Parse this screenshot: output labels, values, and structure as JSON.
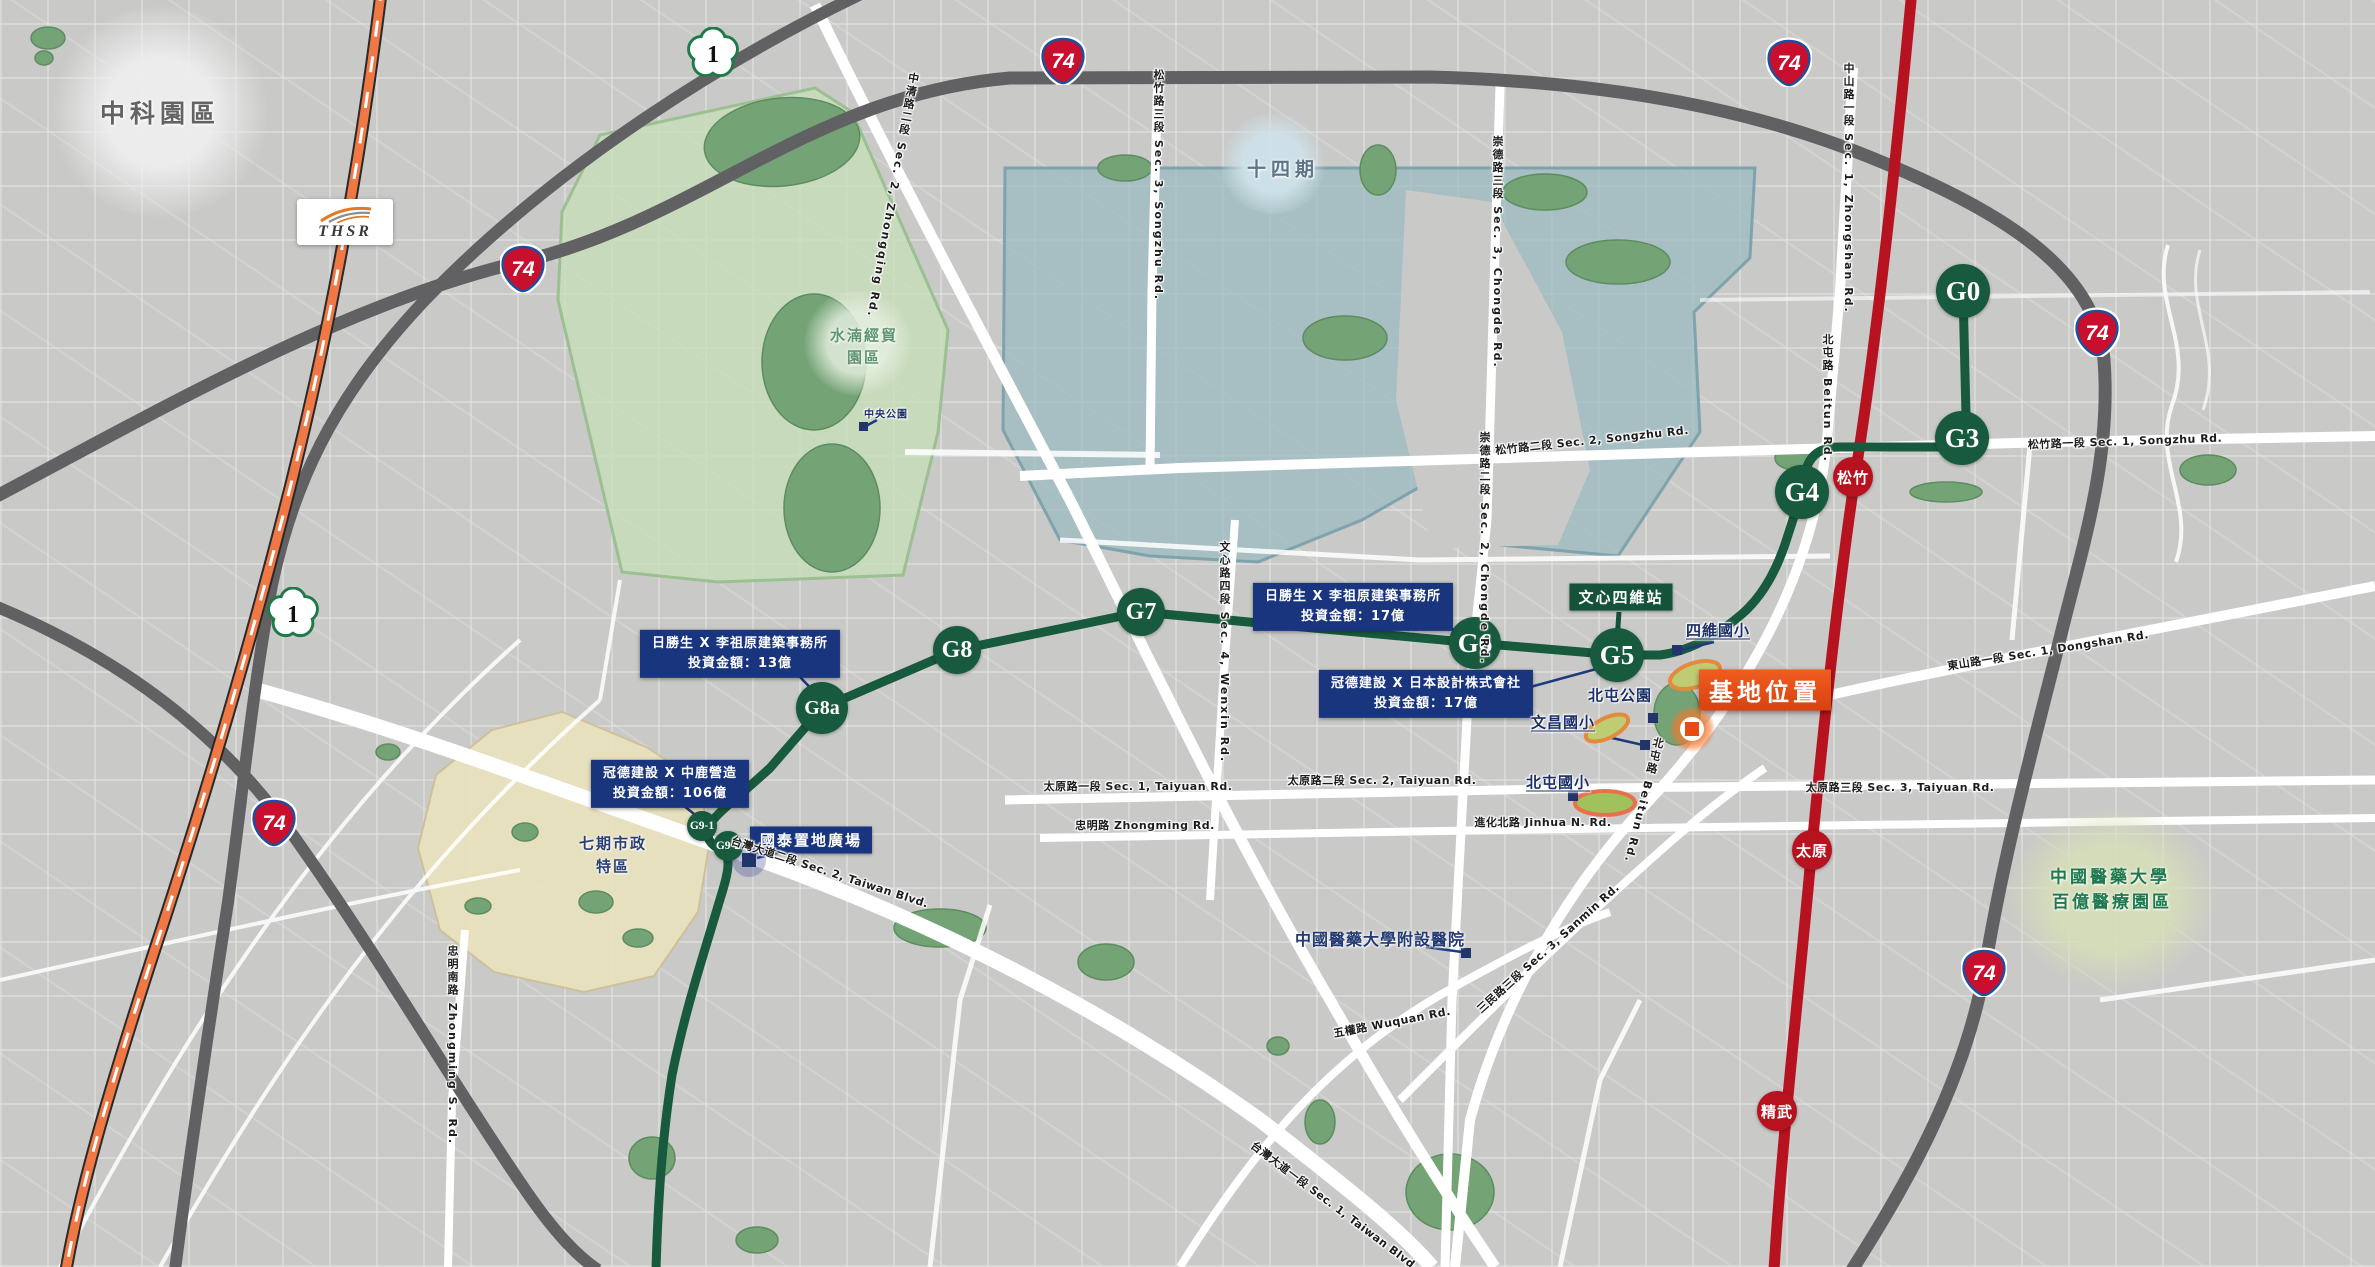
{
  "colors": {
    "map_background": "#c9c9c8",
    "green_line": "#185a3d",
    "red_line": "#b6121f",
    "highway_gray": "#616163",
    "thsr_orange": "#ef7844",
    "info_box_navy": "#19357e",
    "site_box_orange": "#e8521c",
    "area_shuinan_green": "#c8deba",
    "area_phase14_teal": "#9ebdc2",
    "area_phase7_beige": "#e9e2be"
  },
  "thsr": {
    "label": "THSR"
  },
  "shield_labels": {
    "expressway": "74",
    "national": "1"
  },
  "areas": {
    "zhongke": {
      "label": "中科園區"
    },
    "shuinan": {
      "line1": "水湳經貿",
      "line2": "園區"
    },
    "phase14": {
      "label": "十四期"
    },
    "phase7": {
      "line1": "七期市政",
      "line2": "特區"
    },
    "cmu_hospital": {
      "label": "中國醫藥大學附設醫院"
    },
    "cmu_medical_park": {
      "line1": "中國醫藥大學",
      "line2": "百億醫療園區"
    }
  },
  "site": {
    "label": "基地位置"
  },
  "transit": {
    "wenxin_siwei_box": {
      "label": "文心四維站"
    },
    "green_line_stations": [
      {
        "id": "G0",
        "name": "g0",
        "x": 1963,
        "y": 291,
        "r": 27
      },
      {
        "id": "G3",
        "name": "g3",
        "x": 1962,
        "y": 438,
        "r": 27
      },
      {
        "id": "G4",
        "name": "g4",
        "x": 1802,
        "y": 492,
        "r": 27
      },
      {
        "id": "G5",
        "name": "g5",
        "x": 1617,
        "y": 655,
        "r": 27
      },
      {
        "id": "G6",
        "name": "g6",
        "x": 1475,
        "y": 643,
        "r": 26
      },
      {
        "id": "G7",
        "name": "g7",
        "x": 1141,
        "y": 612,
        "r": 24
      },
      {
        "id": "G8",
        "name": "g8",
        "x": 957,
        "y": 650,
        "r": 24
      },
      {
        "id": "G8a",
        "name": "g8a",
        "x": 822,
        "y": 708,
        "r": 26
      },
      {
        "id": "G9-1",
        "name": "g9-1",
        "x": 702,
        "y": 826,
        "r": 15
      },
      {
        "id": "G9-2",
        "name": "g9-2",
        "x": 728,
        "y": 846,
        "r": 15
      }
    ],
    "red_line_stations": [
      {
        "id": "松竹",
        "name": "songzhu",
        "x": 1853,
        "y": 477,
        "r": 20
      },
      {
        "id": "太原",
        "name": "taiyuan",
        "x": 1812,
        "y": 850,
        "r": 20
      },
      {
        "id": "精武",
        "name": "jingwu",
        "x": 1777,
        "y": 1111,
        "r": 20
      }
    ],
    "expressway_shields": [
      {
        "x": 1063,
        "y": 60
      },
      {
        "x": 1789,
        "y": 62
      },
      {
        "x": 2097,
        "y": 332
      },
      {
        "x": 523,
        "y": 268
      },
      {
        "x": 274,
        "y": 822
      },
      {
        "x": 1984,
        "y": 972
      }
    ],
    "national_highway_shields": [
      {
        "x": 713,
        "y": 53
      },
      {
        "x": 293,
        "y": 613
      }
    ]
  },
  "investment_boxes": [
    {
      "line1": "日勝生 X 李祖原建築事務所",
      "line2": "投資金額：13億",
      "x": 740,
      "y": 654
    },
    {
      "line1": "日勝生 X 李祖原建築事務所",
      "line2": "投資金額：17億",
      "x": 1353,
      "y": 607
    },
    {
      "line1": "冠德建設 X 日本設計株式會社",
      "line2": "投資金額：17億",
      "x": 1426,
      "y": 694
    },
    {
      "line1": "冠德建設 X 中鹿營造",
      "line2": "投資金額：106億",
      "x": 670,
      "y": 784
    }
  ],
  "pois": {
    "cathay": {
      "label": "國泰置地廣場"
    },
    "labels": [
      {
        "text": "四維國小",
        "name": "siwei-elementary-school-label",
        "x": 1718,
        "y": 630,
        "fs": 15,
        "underline": true
      },
      {
        "text": "文昌國小",
        "name": "wenchang-elementary-school-label",
        "x": 1563,
        "y": 722,
        "fs": 15,
        "underline": true
      },
      {
        "text": "北屯國小",
        "name": "beitun-elementary-school-label",
        "x": 1558,
        "y": 782,
        "fs": 15,
        "underline": true
      },
      {
        "text": "北屯公園",
        "name": "beitun-park-label",
        "x": 1620,
        "y": 695,
        "fs": 15
      },
      {
        "text": "中央公園",
        "name": "central-park-label",
        "x": 886,
        "y": 413,
        "fs": 10
      }
    ]
  },
  "road_labels": [
    {
      "text": "松竹路三段 Sec. 3, Songzhu Rd.",
      "x": 1158,
      "y": 185,
      "vertical": true
    },
    {
      "text": "松竹路二段 Sec. 2, Songzhu Rd.",
      "x": 1592,
      "y": 440,
      "angle": -6
    },
    {
      "text": "松竹路一段 Sec. 1, Songzhu Rd.",
      "x": 2125,
      "y": 441,
      "angle": -2
    },
    {
      "text": "中清路二段 Sec. 2, Zhongqing Rd.",
      "x": 892,
      "y": 195,
      "vertical": true,
      "angle": 10
    },
    {
      "text": "中山路一段 Sec. 1, Zhongshan Rd.",
      "x": 1848,
      "y": 188,
      "vertical": true
    },
    {
      "text": "北屯路 Beitun Rd.",
      "x": 1827,
      "y": 398,
      "vertical": true
    },
    {
      "text": "北屯路 Beitun Rd.",
      "x": 1643,
      "y": 800,
      "vertical": true,
      "angle": 14
    },
    {
      "text": "崇德路三段 Sec. 3, Chongde Rd.",
      "x": 1497,
      "y": 252,
      "vertical": true
    },
    {
      "text": "崇德路二段 Sec. 2, Chongde Rd.",
      "x": 1484,
      "y": 548,
      "vertical": true
    },
    {
      "text": "文心路四段 Sec. 4, Wenxin Rd.",
      "x": 1224,
      "y": 652,
      "vertical": true
    },
    {
      "text": "東山路一段 Sec. 1, Dongshan Rd.",
      "x": 2048,
      "y": 650,
      "angle": -9
    },
    {
      "text": "太原路一段 Sec. 1, Taiyuan Rd.",
      "x": 1138,
      "y": 786
    },
    {
      "text": "太原路二段 Sec. 2, Taiyuan Rd.",
      "x": 1382,
      "y": 780
    },
    {
      "text": "太原路三段 Sec. 3, Taiyuan Rd.",
      "x": 1900,
      "y": 787
    },
    {
      "text": "忠明路 Zhongming Rd.",
      "x": 1145,
      "y": 825
    },
    {
      "text": "進化北路 Jinhua N. Rd.",
      "x": 1543,
      "y": 822
    },
    {
      "text": "三民路三段 Sec. 3, Sanmin Rd.",
      "x": 1548,
      "y": 948,
      "angle": -42
    },
    {
      "text": "五權路 Wuquan Rd.",
      "x": 1392,
      "y": 1022,
      "angle": -11
    },
    {
      "text": "台灣大道二段 Sec. 2, Taiwan Blvd.",
      "x": 830,
      "y": 872,
      "angle": 18
    },
    {
      "text": "台灣大道一段 Sec. 1, Taiwan Blvd.",
      "x": 1335,
      "y": 1206,
      "angle": 37
    },
    {
      "text": "忠明南路 Zhongming S. Rd.",
      "x": 452,
      "y": 1045,
      "vertical": true
    }
  ]
}
